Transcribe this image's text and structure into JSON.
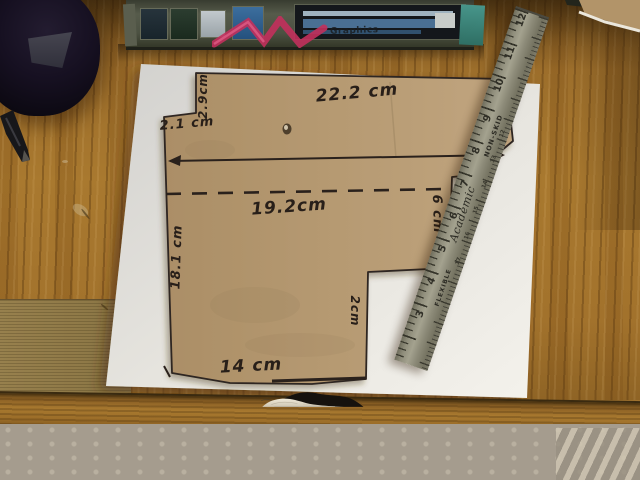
{
  "cardboard_template": {
    "measurements": {
      "top_width": "22.2 cm",
      "top_left_notch_height": "2.9cm",
      "top_left_notch_width": "2.1 cm",
      "right_top_height": "5.2cm",
      "middle_width": "19.2cm",
      "right_middle_height": "6 cm",
      "left_height": "18.1 cm",
      "right_step_height": "2cm",
      "bottom_width": "14 cm"
    }
  },
  "ruler": {
    "brand": "Academic",
    "texts": {
      "flexible": "FLEXIBLE",
      "non_skid": "NON-SKID"
    },
    "cm_numbers": [
      "12",
      "11",
      "10",
      "9",
      "8",
      "7",
      "6",
      "5",
      "4",
      "3"
    ],
    "edge_numbers": [
      "12",
      "13",
      "14",
      "15",
      "16",
      "17"
    ]
  },
  "box_top": {
    "visible_text": "Graphics"
  },
  "colors": {
    "wood": "#a0722e",
    "wood_dark": "#6f4e1d",
    "paper": "#eceae4",
    "cardboard": "#b49871",
    "marker_ink": "#281f19",
    "ruler_metal": "#8d8b79",
    "carpet": "#a59c8e",
    "fabric_black": "#16120e",
    "fabric_cream": "#e3dccb",
    "box_green": "#4e5345",
    "accent_pink": "#c2305c",
    "teal_patch": "#3f8b80"
  }
}
